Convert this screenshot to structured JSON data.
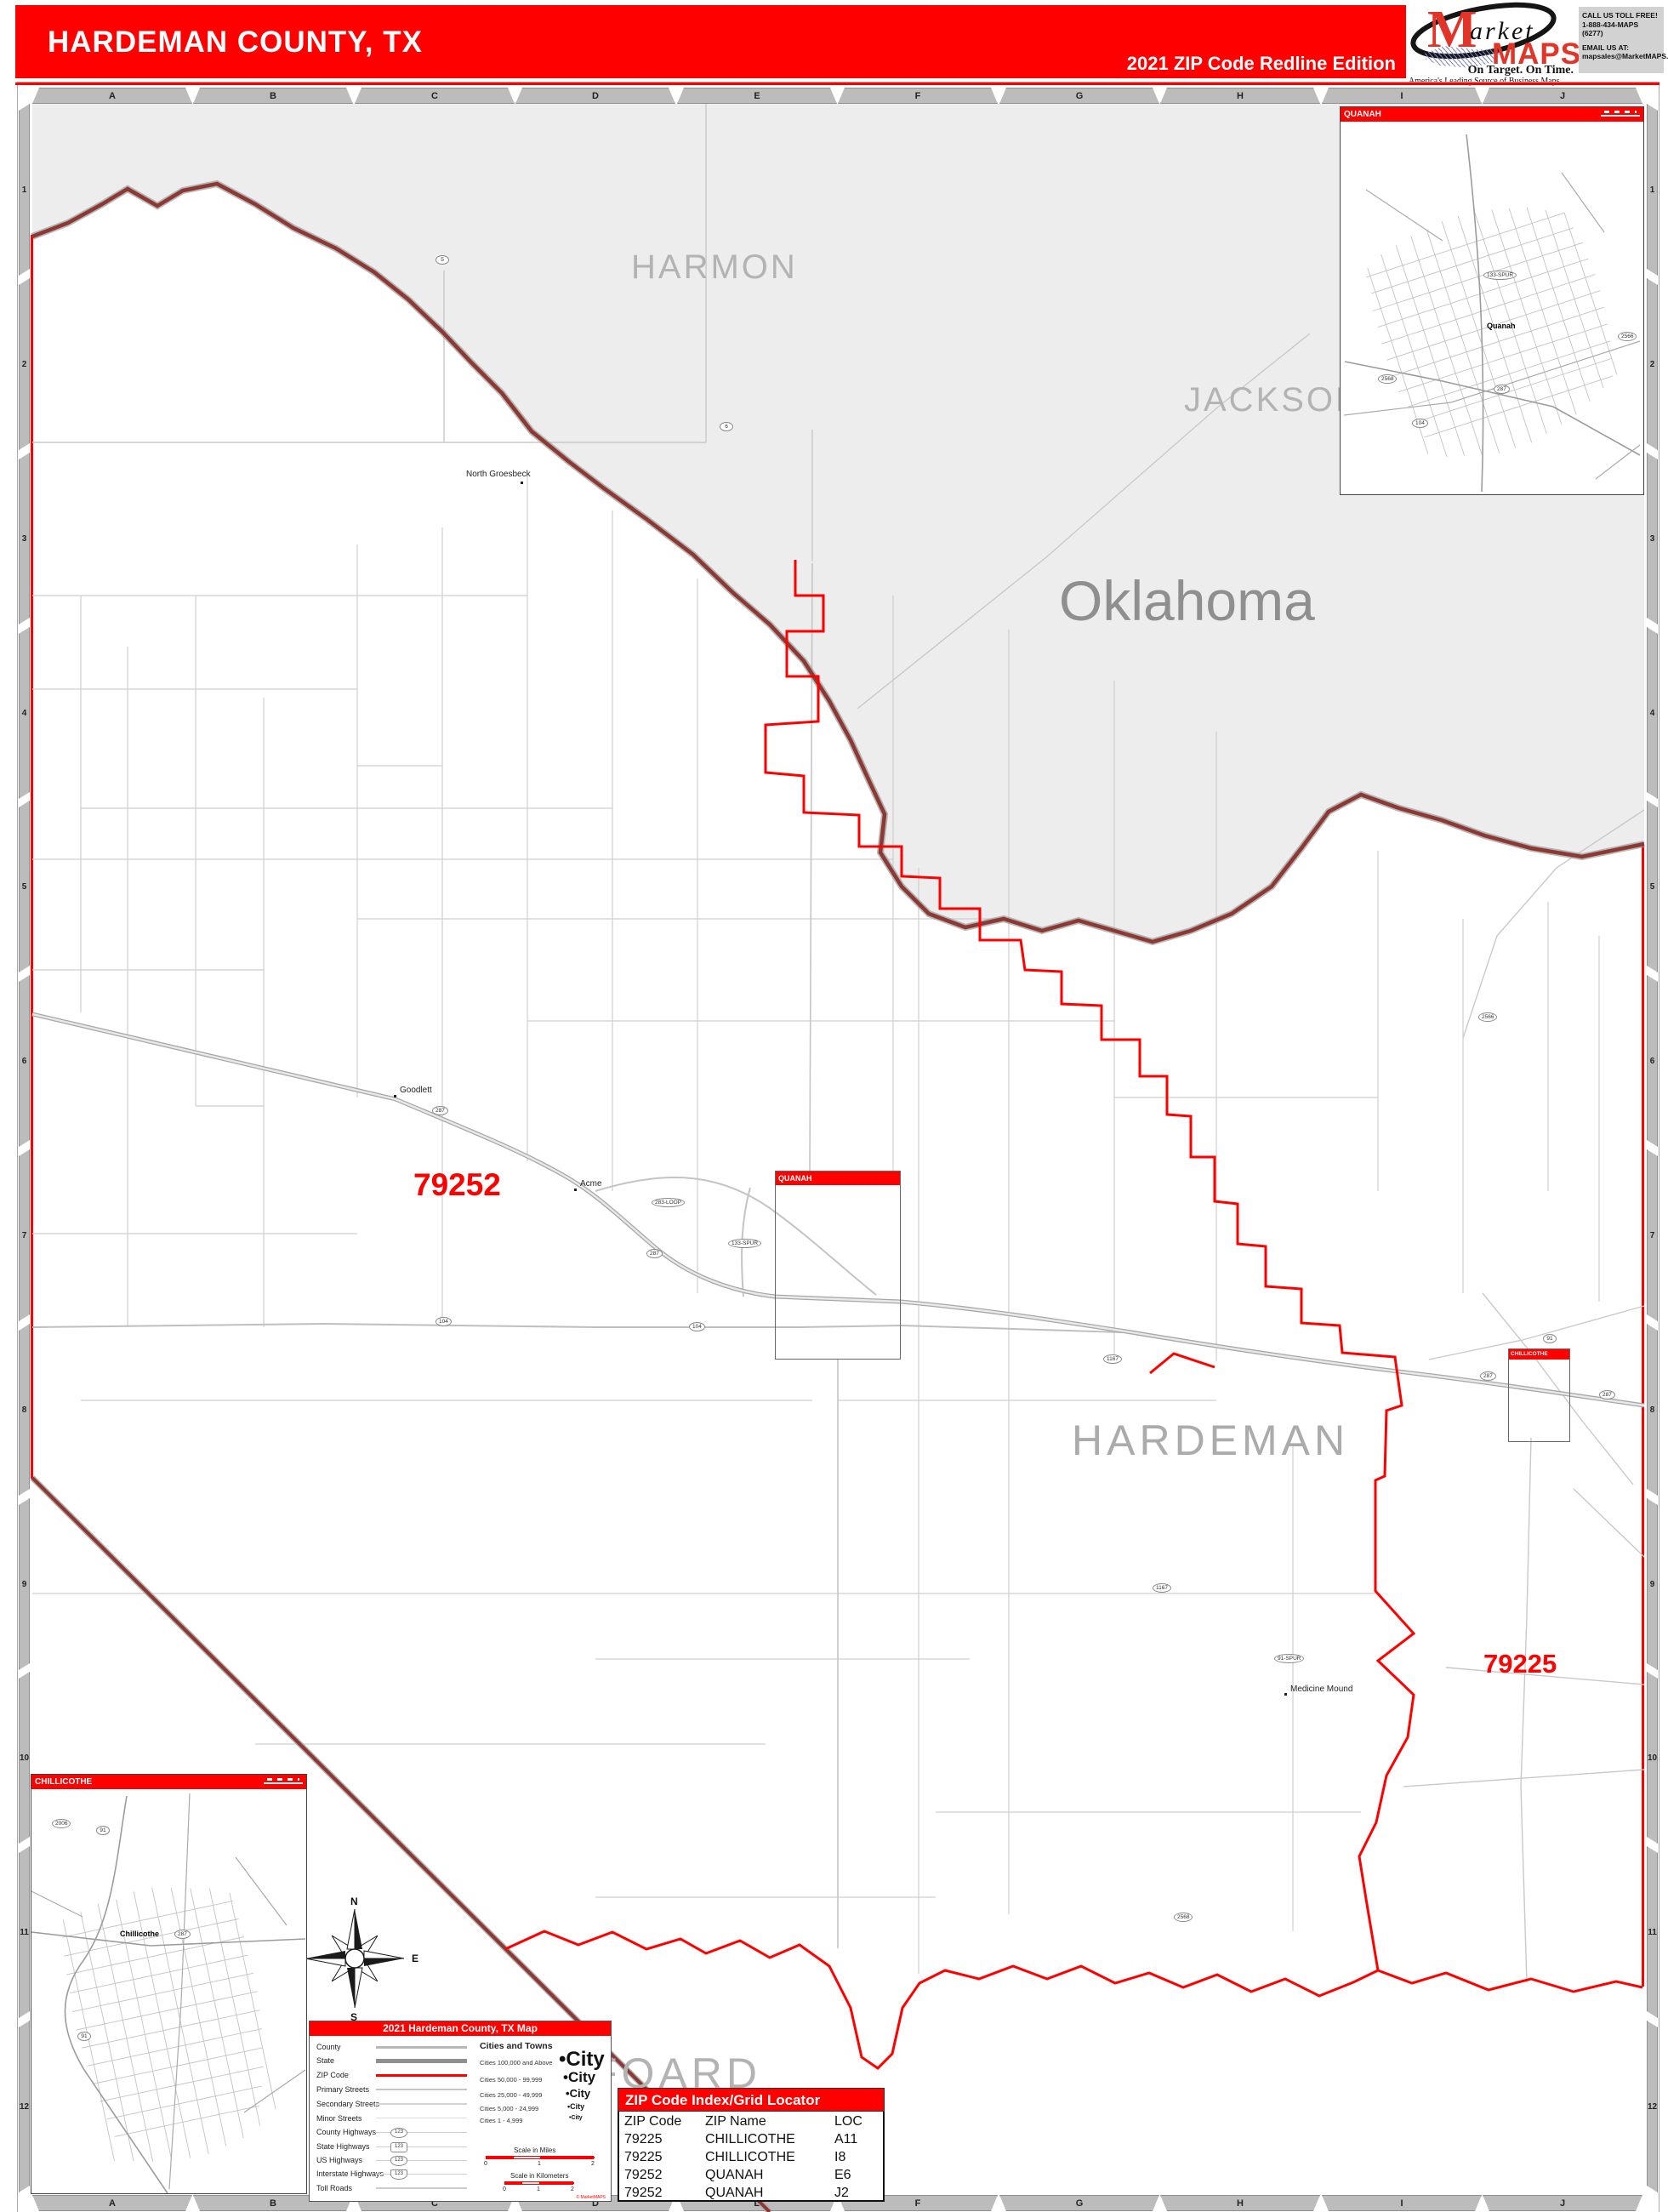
{
  "header": {
    "title": "HARDEMAN COUNTY, TX",
    "edition": "2021 ZIP Code Redline Edition",
    "logo": {
      "m": "M",
      "arket": "arket",
      "maps": "MAPS",
      "tagline": "On Target.  On Time.",
      "subtitle": "America's Leading Source of Business Maps"
    },
    "contact": {
      "line1": "CALL  US  TOLL  FREE!",
      "line2": "1-888-434-MAPS  (6277)",
      "line3": "EMAIL  US  AT:",
      "line4": "mapsales@MarketMAPS.com"
    }
  },
  "grid": {
    "cols": [
      "A",
      "B",
      "C",
      "D",
      "E",
      "F",
      "G",
      "H",
      "I",
      "J"
    ],
    "rows": [
      "1",
      "2",
      "3",
      "4",
      "5",
      "6",
      "7",
      "8",
      "9",
      "10",
      "11",
      "12"
    ]
  },
  "map": {
    "state_label": "Oklahoma",
    "county_harmon": "HARMON",
    "county_jackson": "JACKSON",
    "county_hardeman": "HARDEMAN",
    "county_foard": "FOARD",
    "zip_west": "79252",
    "zip_east": "79225",
    "towns": {
      "goodlett": "Goodlett",
      "acme": "Acme",
      "medicine_mound": "Medicine Mound",
      "north_groesbeck": "North Groesbeck"
    },
    "shields": [
      {
        "label": "287"
      },
      {
        "label": "287"
      },
      {
        "label": "287"
      },
      {
        "label": "287"
      },
      {
        "label": "104"
      },
      {
        "label": "104"
      },
      {
        "label": "283-LOOP"
      },
      {
        "label": "133-SPUR"
      },
      {
        "label": "1167"
      },
      {
        "label": "1167"
      },
      {
        "label": "91"
      },
      {
        "label": "91-SPUR"
      },
      {
        "label": "6"
      },
      {
        "label": "5"
      },
      {
        "label": "2566"
      },
      {
        "label": "2568"
      }
    ],
    "colors": {
      "zip_boundary": "#fe0000",
      "state_boundary": "#8d3832",
      "oklahoma_fill": "#ededed"
    }
  },
  "indicator_boxes": {
    "quanah": "QUANAH",
    "chillicothe": "CHILLICOTHE"
  },
  "insets": {
    "quanah": {
      "title": "QUANAH",
      "city": "Quanah",
      "shields": [
        {
          "label": "133-SPUR"
        },
        {
          "label": "287"
        },
        {
          "label": "2568"
        },
        {
          "label": "104"
        },
        {
          "label": "2566"
        }
      ]
    },
    "chillicothe": {
      "title": "CHILLICOTHE",
      "city": "Chillicothe",
      "shields": [
        {
          "label": "2006"
        },
        {
          "label": "91"
        },
        {
          "label": "287"
        },
        {
          "label": "91"
        }
      ]
    }
  },
  "compass": {
    "n": "N",
    "e": "E",
    "s": "S",
    "w": "W"
  },
  "legend": {
    "title": "2021 Hardeman County, TX Map",
    "items": [
      {
        "label": "County"
      },
      {
        "label": "State"
      },
      {
        "label": "ZIP Code"
      },
      {
        "label": "Primary Streets"
      },
      {
        "label": "Secondary Streets"
      },
      {
        "label": "Minor Streets"
      },
      {
        "label": "County Highways"
      },
      {
        "label": "State Highways"
      },
      {
        "label": "US Highways"
      },
      {
        "label": "Interstate Highways"
      },
      {
        "label": "Toll Roads"
      }
    ],
    "shield_sample": "123",
    "cities_title": "Cities and Towns",
    "city_classes": [
      {
        "range": "Cities 100,000 and Above",
        "bullet": "•",
        "sample": "City"
      },
      {
        "range": "Cities 50,000 - 99,999",
        "bullet": "•",
        "sample": "City"
      },
      {
        "range": "Cities 25,000 - 49,999",
        "bullet": "•",
        "sample": "City"
      },
      {
        "range": "Cities 5,000 - 24,999",
        "bullet": "•",
        "sample": "City"
      },
      {
        "range": "Cities 1 - 4,999",
        "bullet": "•",
        "sample": "City"
      }
    ],
    "scale_miles": {
      "label": "Scale in Miles",
      "t0": "0",
      "t1": "1",
      "t2": "2"
    },
    "scale_km": {
      "label": "Scale in Kilometers",
      "t0": "0",
      "t1": "1",
      "t2": "2"
    },
    "copyright": "© MarketMAPS"
  },
  "zip_table": {
    "title": "ZIP Code Index/Grid Locator",
    "col_zip": "ZIP Code",
    "col_name": "ZIP Name",
    "col_loc": "LOC",
    "rows": [
      {
        "zip": "79225",
        "name": "CHILLICOTHE",
        "loc": "A11"
      },
      {
        "zip": "79225",
        "name": "CHILLICOTHE",
        "loc": "I8"
      },
      {
        "zip": "79252",
        "name": "QUANAH",
        "loc": "E6"
      },
      {
        "zip": "79252",
        "name": "QUANAH",
        "loc": "J2"
      }
    ]
  }
}
